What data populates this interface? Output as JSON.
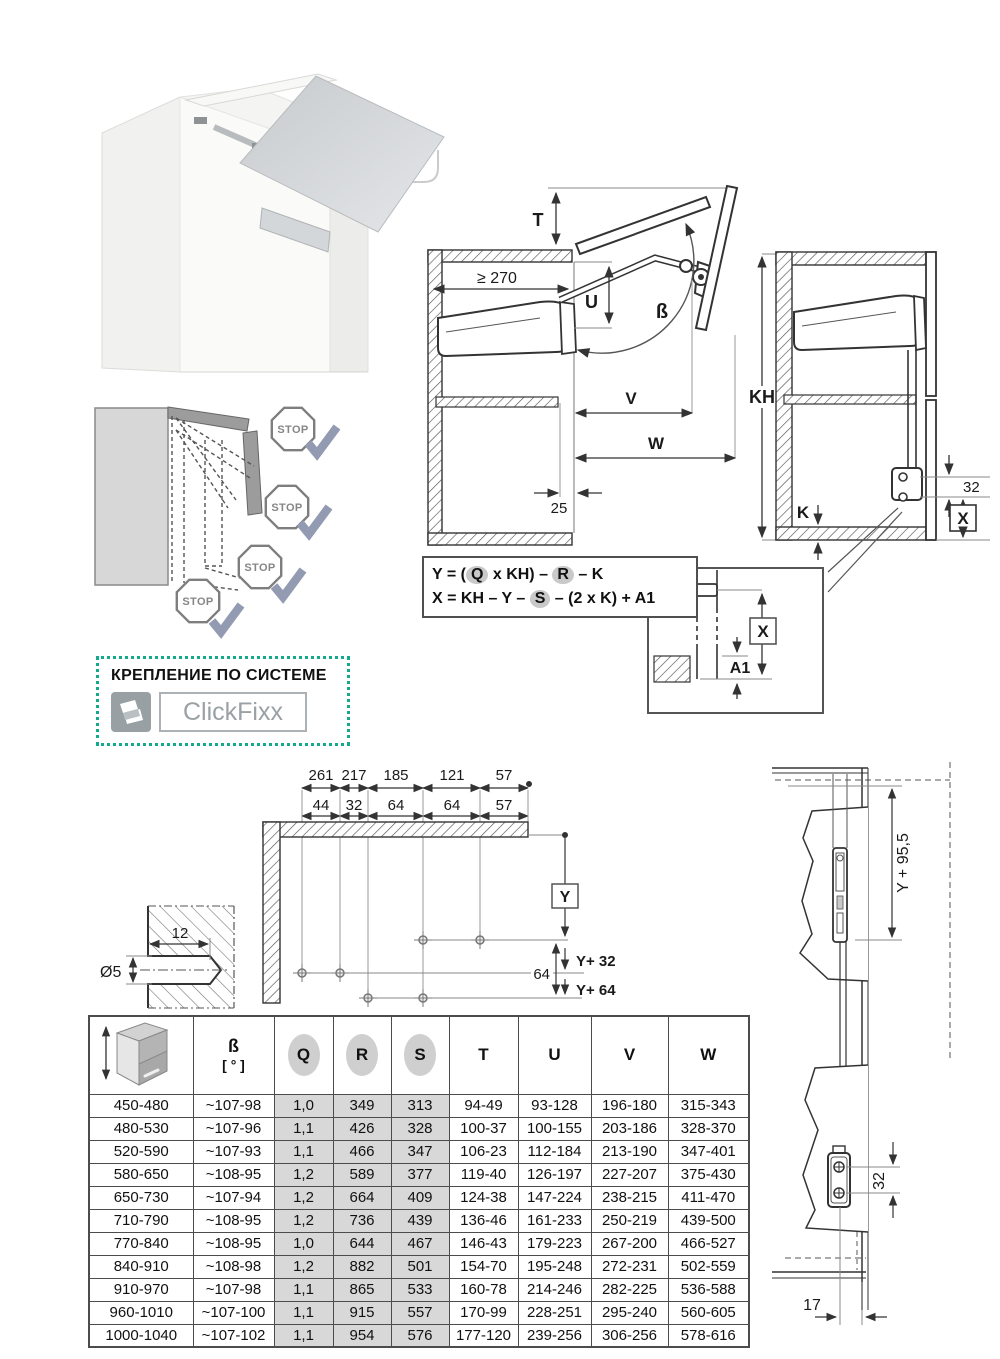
{
  "open_diagram": {
    "t": "T",
    "min_depth": "≥ 270",
    "u": "U",
    "beta": "ß",
    "v": "V",
    "w": "W",
    "front": "25"
  },
  "closed_diagram": {
    "kh": "KH",
    "k": "K",
    "screw_gap": "32",
    "x": "X"
  },
  "formula_box": {
    "f1": [
      "Y = (",
      "Q",
      " x KH) – ",
      "R",
      " – K"
    ],
    "f2": [
      "X = KH – Y – ",
      "S",
      " – (2 x K) + A1"
    ]
  },
  "eye_detail": {
    "x": "X",
    "a1": "A1"
  },
  "stop_diagram": {
    "stop": "STOP"
  },
  "mounting": {
    "title": "КРЕПЛЕНИЕ ПО СИСТЕМЕ",
    "system": "ClickFixx"
  },
  "drilling": {
    "row1": [
      "261",
      "217",
      "185",
      "121",
      "57"
    ],
    "row2": [
      "44",
      "32",
      "64",
      "64",
      "57"
    ],
    "y": "Y",
    "y32": "Y+ 32",
    "y64": "Y+ 64",
    "gap64": "64",
    "depth": "12",
    "dia": "Ø5"
  },
  "side_view": {
    "y955": "Y + 95,5",
    "screw_gap": "32",
    "offset": "17"
  },
  "table": {
    "header": {
      "beta": "ß",
      "beta_unit": "[ ° ]",
      "q": "Q",
      "r": "R",
      "s": "S",
      "t": "T",
      "u": "U",
      "v": "V",
      "w": "W"
    },
    "rows": [
      [
        "450-480",
        "~107-98",
        "1,0",
        "349",
        "313",
        "94-49",
        "93-128",
        "196-180",
        "315-343"
      ],
      [
        "480-530",
        "~107-96",
        "1,1",
        "426",
        "328",
        "100-37",
        "100-155",
        "203-186",
        "328-370"
      ],
      [
        "520-590",
        "~107-93",
        "1,1",
        "466",
        "347",
        "106-23",
        "112-184",
        "213-190",
        "347-401"
      ],
      [
        "580-650",
        "~108-95",
        "1,2",
        "589",
        "377",
        "119-40",
        "126-197",
        "227-207",
        "375-430"
      ],
      [
        "650-730",
        "~107-94",
        "1,2",
        "664",
        "409",
        "124-38",
        "147-224",
        "238-215",
        "411-470"
      ],
      [
        "710-790",
        "~108-95",
        "1,2",
        "736",
        "439",
        "136-46",
        "161-233",
        "250-219",
        "439-500"
      ],
      [
        "770-840",
        "~108-95",
        "1,0",
        "644",
        "467",
        "146-43",
        "179-223",
        "267-200",
        "466-527"
      ],
      [
        "840-910",
        "~108-98",
        "1,2",
        "882",
        "501",
        "154-70",
        "195-248",
        "272-231",
        "502-559"
      ],
      [
        "910-970",
        "~107-98",
        "1,1",
        "865",
        "533",
        "160-78",
        "214-246",
        "282-225",
        "536-588"
      ],
      [
        "960-1010",
        "~107-100",
        "1,1",
        "915",
        "557",
        "170-99",
        "228-251",
        "295-240",
        "560-605"
      ],
      [
        "1000-1040",
        "~107-102",
        "1,1",
        "954",
        "576",
        "177-120",
        "239-256",
        "306-256",
        "578-616"
      ]
    ]
  },
  "colors": {
    "accent": "#14a88c",
    "check": "#929bb1",
    "line": "#3c3c3c",
    "shade": "#d8d8d8"
  }
}
